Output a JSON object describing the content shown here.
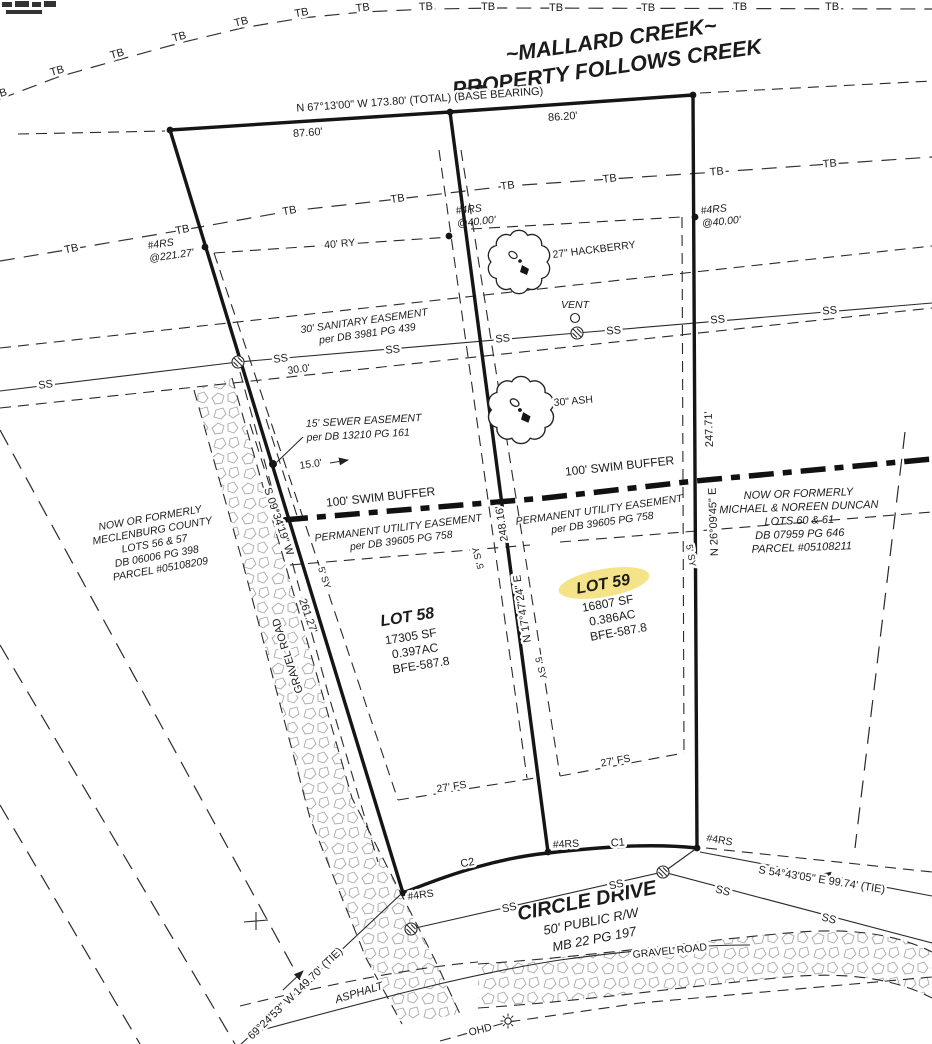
{
  "colors": {
    "ink": "#1b1b1b",
    "highlight": "#f4e07c",
    "pebble": "#a8a8a8",
    "paper": "#ffffff"
  },
  "symbols": {
    "tb": "TB",
    "ss": "SS",
    "creek_edge": "B",
    "rebar": "#4RS",
    "vent": "VENT",
    "ohd": "OHD",
    "curve1": "C1",
    "curve2": "C2"
  },
  "icons": {
    "manhole": "manhole-icon",
    "vent_circle": "vent-circle-icon",
    "utility_pole": "utility-pole-light-icon",
    "tree": "tree-canopy-icon",
    "corner": "corner-monument-dot"
  },
  "title": {
    "line1": "~MALLARD CREEK~",
    "line2": "PROPERTY FOLLOWS CREEK"
  },
  "north_boundary": {
    "bearing": "N 67°13'00\" W   173.80'  (TOTAL)  (BASE BEARING)",
    "seg_left": "87.60'",
    "seg_right": "86.20'"
  },
  "rebar_offsets": {
    "center": "@40.00'",
    "east": "@40.00'",
    "west": "@221.27'"
  },
  "bearings": {
    "west_dir": "S 09°34'19\" W",
    "west_dist": "261.27'",
    "center_dir": "N 17°47'24\" E",
    "center_dist": "248.16'",
    "east_dir": "N 26°09'45\" E",
    "east_dist": "247.71'",
    "tie_se": "S 54°43'05\" E   99.74'  (TIE)",
    "tie_sw": "69°24'53\" W   149.70'  (TIE)"
  },
  "easements": {
    "sanitary": {
      "line1": "30' SANITARY EASEMENT",
      "line2": "per DB 3981 PG 439",
      "width": "30.0'"
    },
    "sewer": {
      "line1": "15' SEWER EASEMENT",
      "line2": "per DB 13210 PG 161",
      "width": "15.0'"
    },
    "utility": {
      "line1": "PERMANENT UTILITY EASEMENT",
      "line2": "per DB 39605 PG 758"
    },
    "swim_buffer": "100' SWIM BUFFER"
  },
  "setbacks": {
    "rear": "40' RY",
    "front": "27' FS",
    "side": "5' SY"
  },
  "trees": {
    "hackberry": "27\" HACKBERRY",
    "ash": "30\" ASH"
  },
  "lots": {
    "lot58": {
      "name": "LOT 58",
      "area_sf": "17305 SF",
      "area_ac": "0.397AC",
      "bfe": "BFE-587.8"
    },
    "lot59": {
      "name": "LOT 59",
      "area_sf": "16807 SF",
      "area_ac": "0.386AC",
      "bfe": "BFE-587.8"
    }
  },
  "adjoiners": {
    "west": {
      "lines": [
        "NOW OR FORMERLY",
        "MECLENBURG COUNTY",
        "LOTS 56 & 57",
        "DB 06006 PG 398",
        "PARCEL #05108209"
      ]
    },
    "east": {
      "lines": [
        "NOW OR FORMERLY",
        "MICHAEL & NOREEN DUNCAN",
        "LOTS 60 & 61",
        "DB 07959 PG 646",
        "PARCEL #05108211"
      ]
    }
  },
  "road": {
    "name": "CIRCLE DRIVE",
    "right_of_way": "50' PUBLIC R/W",
    "map_book": "MB 22 PG 197",
    "asphalt": "ASPHALT",
    "gravel_west": "GRAVEL ROAD",
    "gravel_south": "GRAVEL ROAD"
  }
}
